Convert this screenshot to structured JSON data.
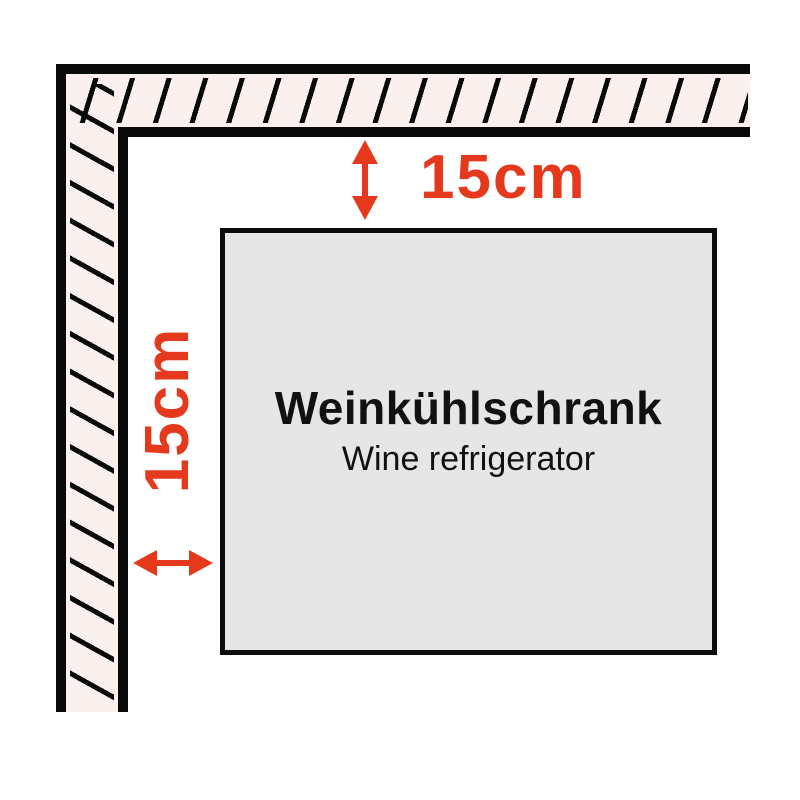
{
  "diagram": {
    "fridge": {
      "title": "Weinkühlschrank",
      "subtitle": "Wine refrigerator"
    },
    "clearances": {
      "top": "15cm",
      "left": "15cm"
    },
    "icons": {
      "top_arrow": "vertical-double-arrow-icon",
      "left_arrow": "horizontal-double-arrow-icon"
    },
    "colors": {
      "accent_red": "#e5391d",
      "wall_fill": "#faf0ee",
      "wall_line": "#0a0a0a",
      "fridge_fill": "#e6e6e6"
    }
  }
}
